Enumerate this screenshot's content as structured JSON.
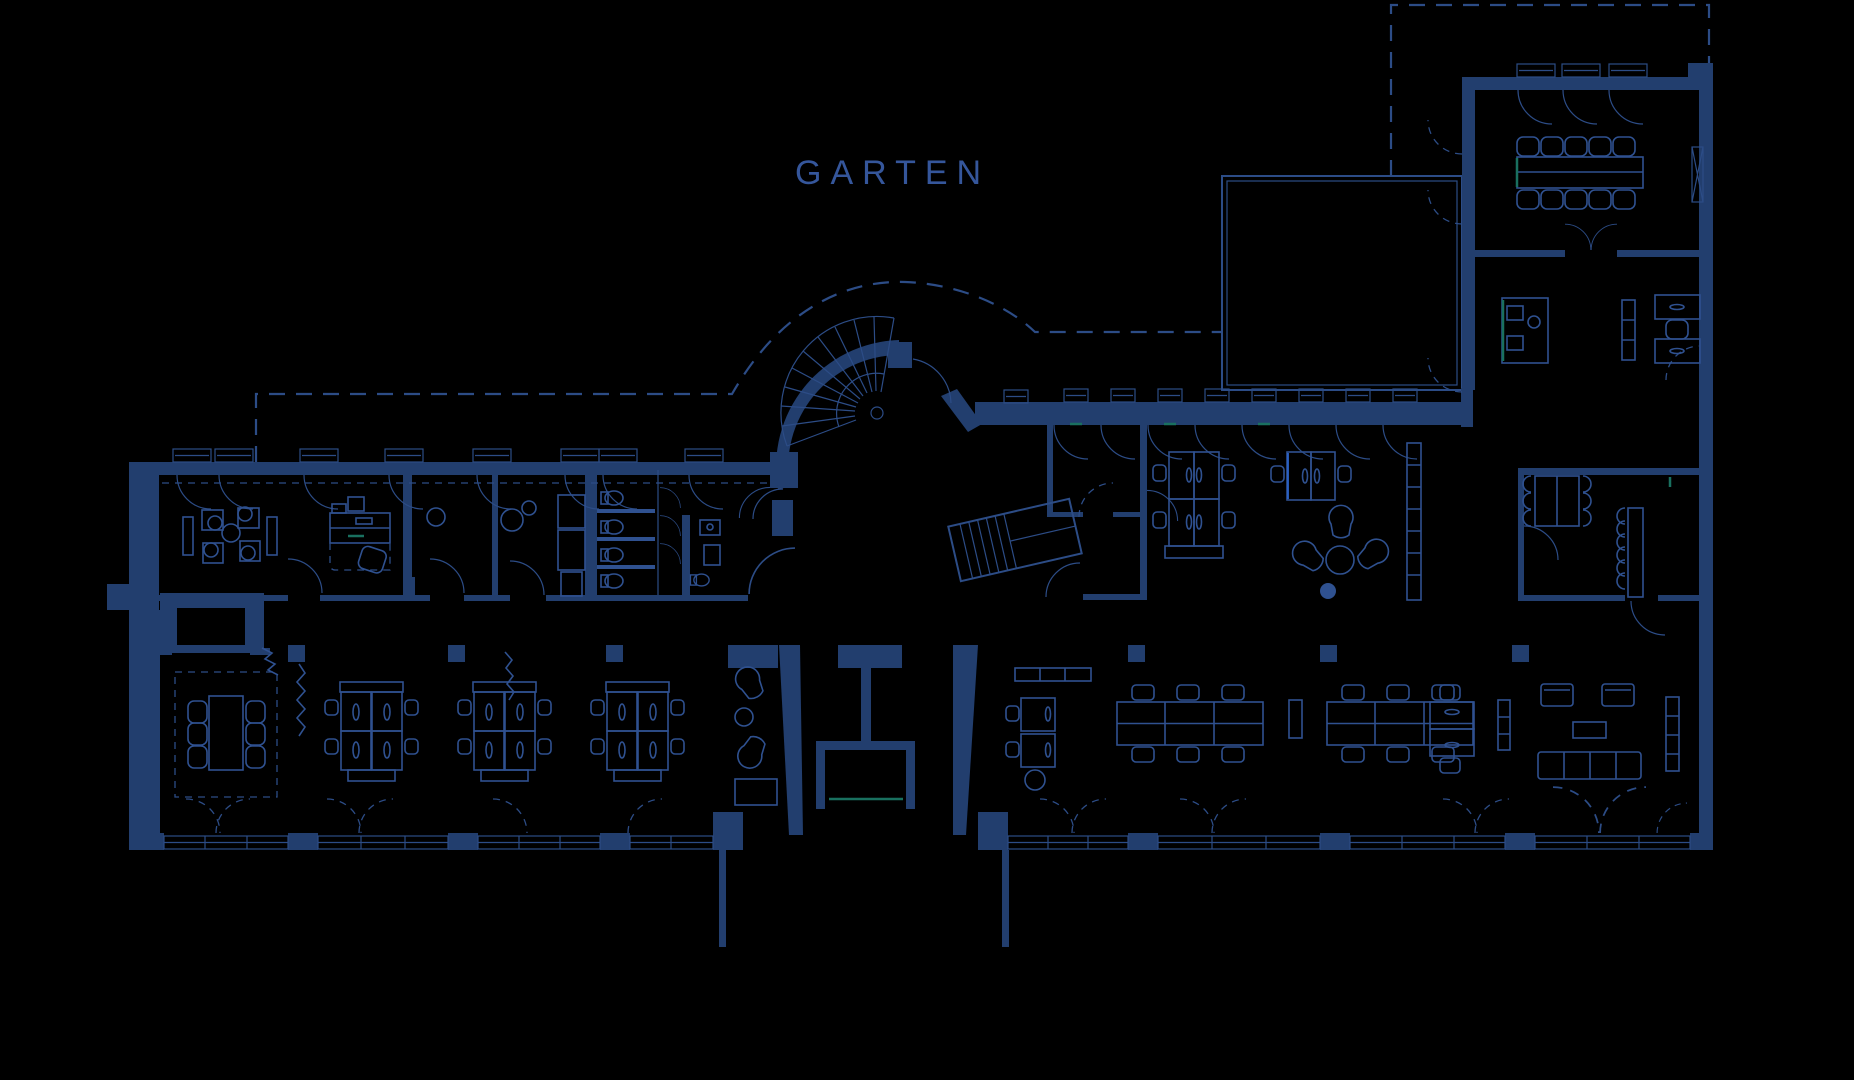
{
  "garten_label": "GARTEN",
  "colors": {
    "background": "#000000",
    "wall": "#223e6e",
    "line": "#2c4c86",
    "furn": "#2f5190",
    "text": "#35569b",
    "teal": "#19705f",
    "accent": "#2a62c9"
  }
}
